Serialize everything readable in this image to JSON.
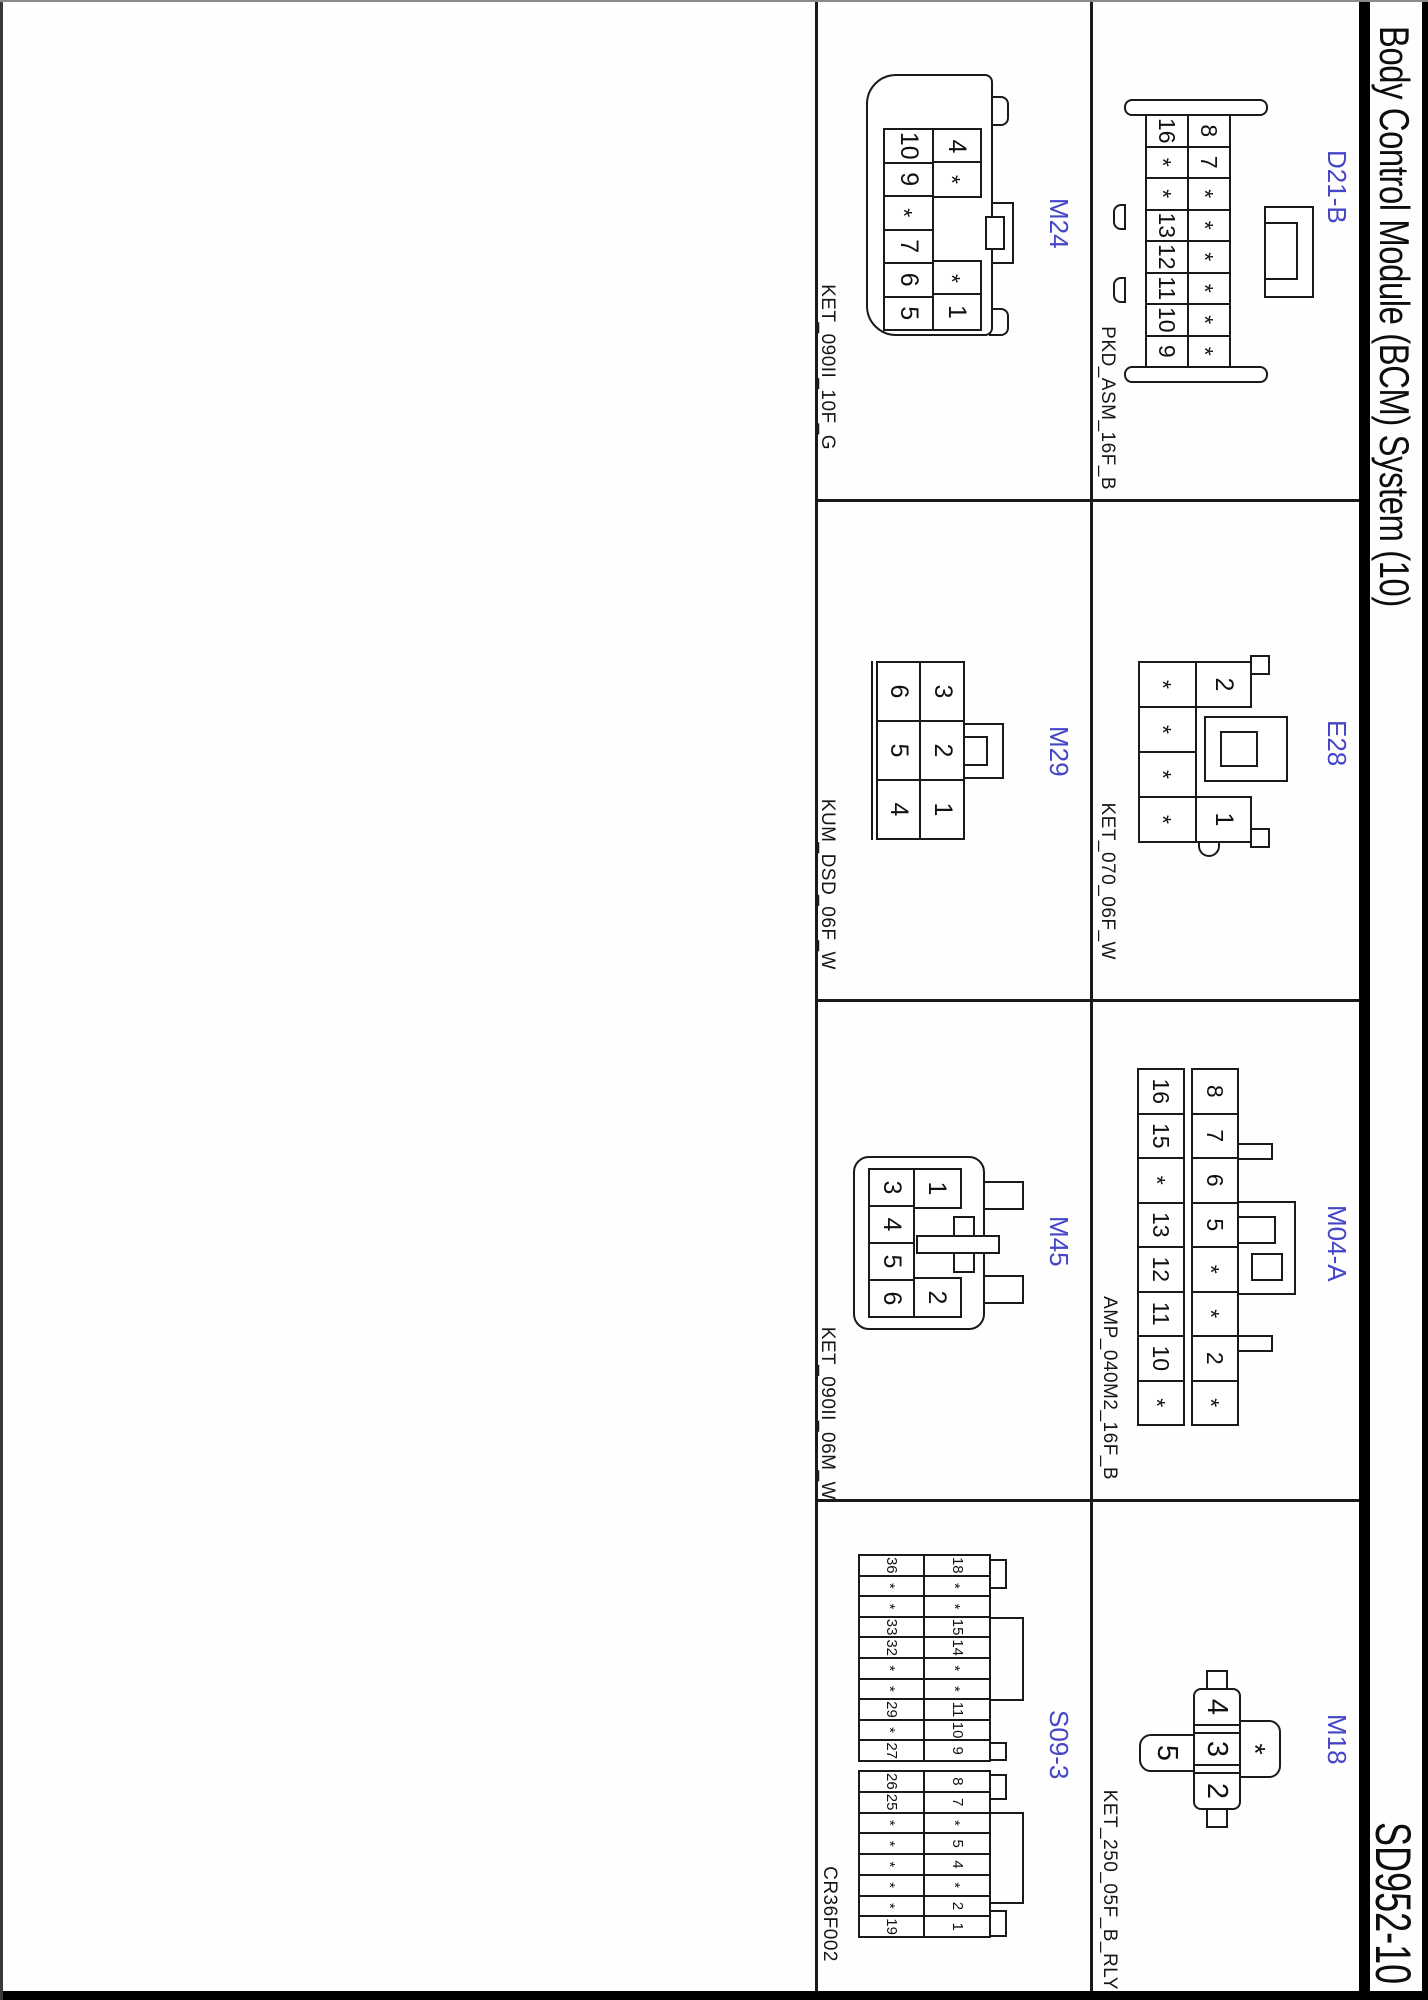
{
  "header": {
    "title": "Body Control Module (BCM) System (10)",
    "code": "SD952-10"
  },
  "figure_code": "CR36F002",
  "colors": {
    "label_blue": "#4545c8",
    "line": "#1a1a1a"
  },
  "connectors": {
    "d21b": {
      "label": "D21-B",
      "part": "PKD_ASM_16F_B",
      "pins_top": [
        "8",
        "7",
        "*",
        "*",
        "*",
        "*",
        "*",
        "*"
      ],
      "pins_bottom": [
        "16",
        "*",
        "*",
        "13",
        "12",
        "11",
        "10",
        "9"
      ]
    },
    "e28": {
      "label": "E28",
      "part": "KET_070_06F_W",
      "pins_top": [
        "2",
        "1"
      ],
      "pins_bottom": [
        "*",
        "*",
        "*",
        "*"
      ]
    },
    "m04a": {
      "label": "M04-A",
      "part": "AMP_040M2_16F_B",
      "pins_top": [
        "8",
        "7",
        "6",
        "5",
        "*",
        "*",
        "2",
        "*"
      ],
      "pins_bottom": [
        "16",
        "15",
        "*",
        "13",
        "12",
        "11",
        "10",
        "*"
      ]
    },
    "m18": {
      "label": "M18",
      "part": "KET_250_05F_B_RLY",
      "pin_above": "*",
      "pins_row": [
        "4",
        "3",
        "2"
      ],
      "pin_below": "5"
    },
    "m24": {
      "label": "M24",
      "part": "KET_090II_10F_G",
      "pins_top": [
        "4",
        "*",
        "*",
        "1"
      ],
      "pins_bottom": [
        "10",
        "9",
        "*",
        "7",
        "6",
        "5"
      ]
    },
    "m29": {
      "label": "M29",
      "part": "KUM_DSD_06F_W",
      "pins_top": [
        "3",
        "2",
        "1"
      ],
      "pins_bottom": [
        "6",
        "5",
        "4"
      ]
    },
    "m45": {
      "label": "M45",
      "part": "KET_090II_06M_W",
      "pins_top": [
        "1",
        "2"
      ],
      "pins_bottom": [
        "3",
        "4",
        "5",
        "6"
      ]
    },
    "s093": {
      "label": "S09-3",
      "block1_top": [
        "18",
        "*",
        "*",
        "15",
        "14",
        "*",
        "*",
        "11",
        "10",
        "9"
      ],
      "block1_bottom": [
        "36",
        "*",
        "*",
        "33",
        "32",
        "*",
        "*",
        "29",
        "*",
        "27"
      ],
      "block2_top": [
        "8",
        "7",
        "*",
        "5",
        "4",
        "*",
        "2",
        "1"
      ],
      "block2_bottom": [
        "26",
        "25",
        "*",
        "*",
        "*",
        "*",
        "*",
        "19"
      ]
    }
  }
}
